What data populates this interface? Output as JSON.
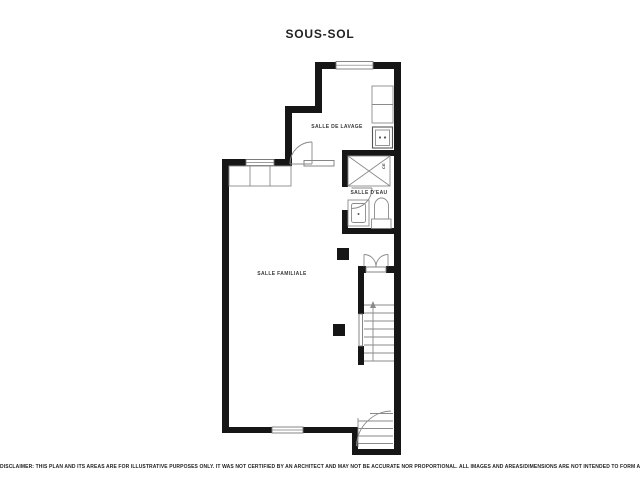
{
  "page": {
    "title": "SOUS-SOL",
    "disclaimer": "DISCLAIMER: THIS PLAN AND ITS AREAS ARE FOR ILLUSTRATIVE PURPOSES ONLY. IT WAS NOT CERTIFIED BY AN ARCHITECT AND MAY NOT BE ACCURATE NOR PROPORTIONAL. ALL IMAGES AND AREAS/DIMENSIONS ARE NOT INTENDED TO FORM ANY CONTRACT OR WARRANTY."
  },
  "rooms": {
    "family_room": {
      "label": "SALLE FAMILIALE"
    },
    "laundry_room": {
      "label": "SALLE DE LAVAGE"
    },
    "bathroom": {
      "label": "SALLE D'EAU"
    },
    "water_heater": {
      "label": "CE"
    }
  },
  "colors": {
    "wall": "#161616",
    "text": "#3a3a3a"
  }
}
